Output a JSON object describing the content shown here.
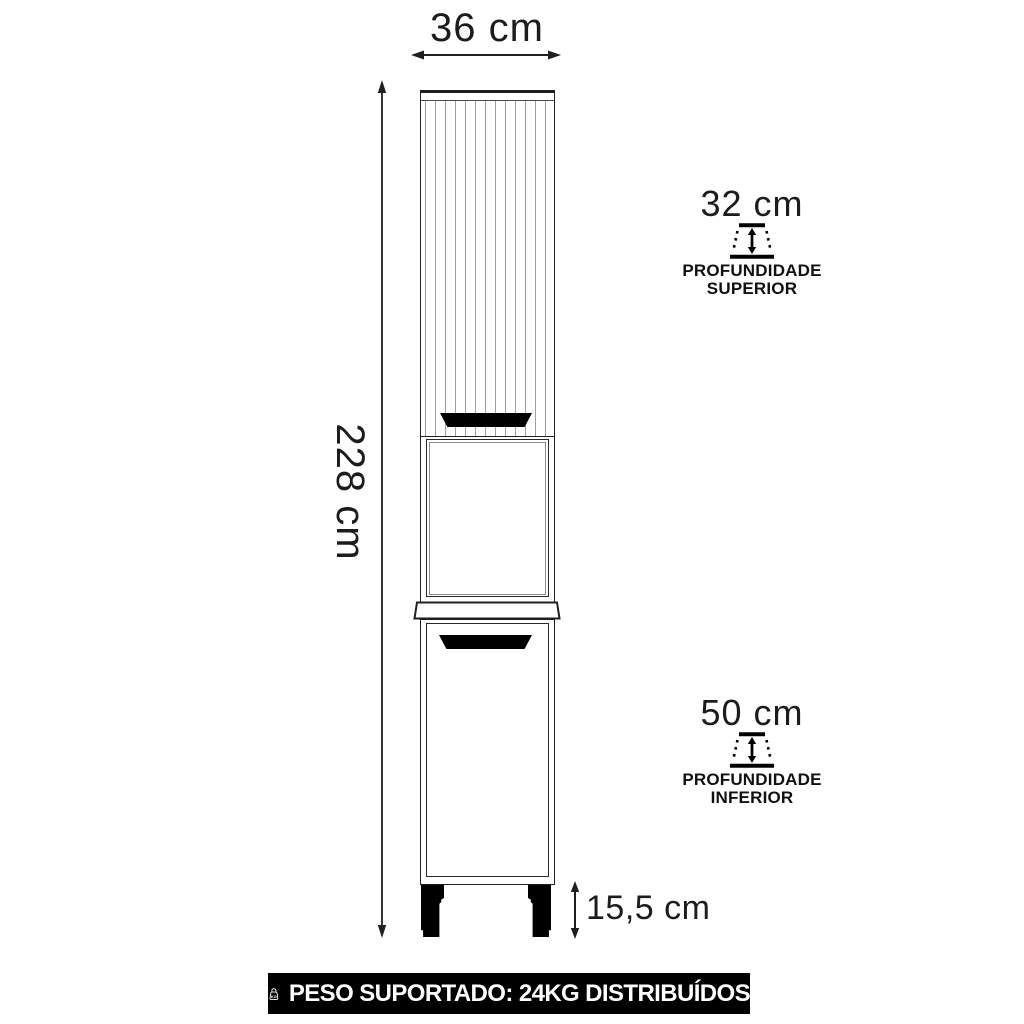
{
  "diagram": {
    "width_dim": "36 cm",
    "height_dim": "228 cm",
    "feet_dim": "15,5 cm",
    "upper_depth": {
      "value": "32 cm",
      "label_line1": "PROFUNDIDADE",
      "label_line2": "SUPERIOR"
    },
    "lower_depth": {
      "value": "50 cm",
      "label_line1": "PROFUNDIDADE",
      "label_line2": "INFERIOR"
    }
  },
  "banner": {
    "text": "PESO SUPORTADO: 24KG DISTRIBUÍDOS",
    "icon_label": "KG"
  },
  "colors": {
    "line": "#1f1f1f",
    "flute_line": "#9e9e9e",
    "handle": "#000000",
    "banner_bg": "#000000",
    "banner_fg": "#ffffff"
  }
}
